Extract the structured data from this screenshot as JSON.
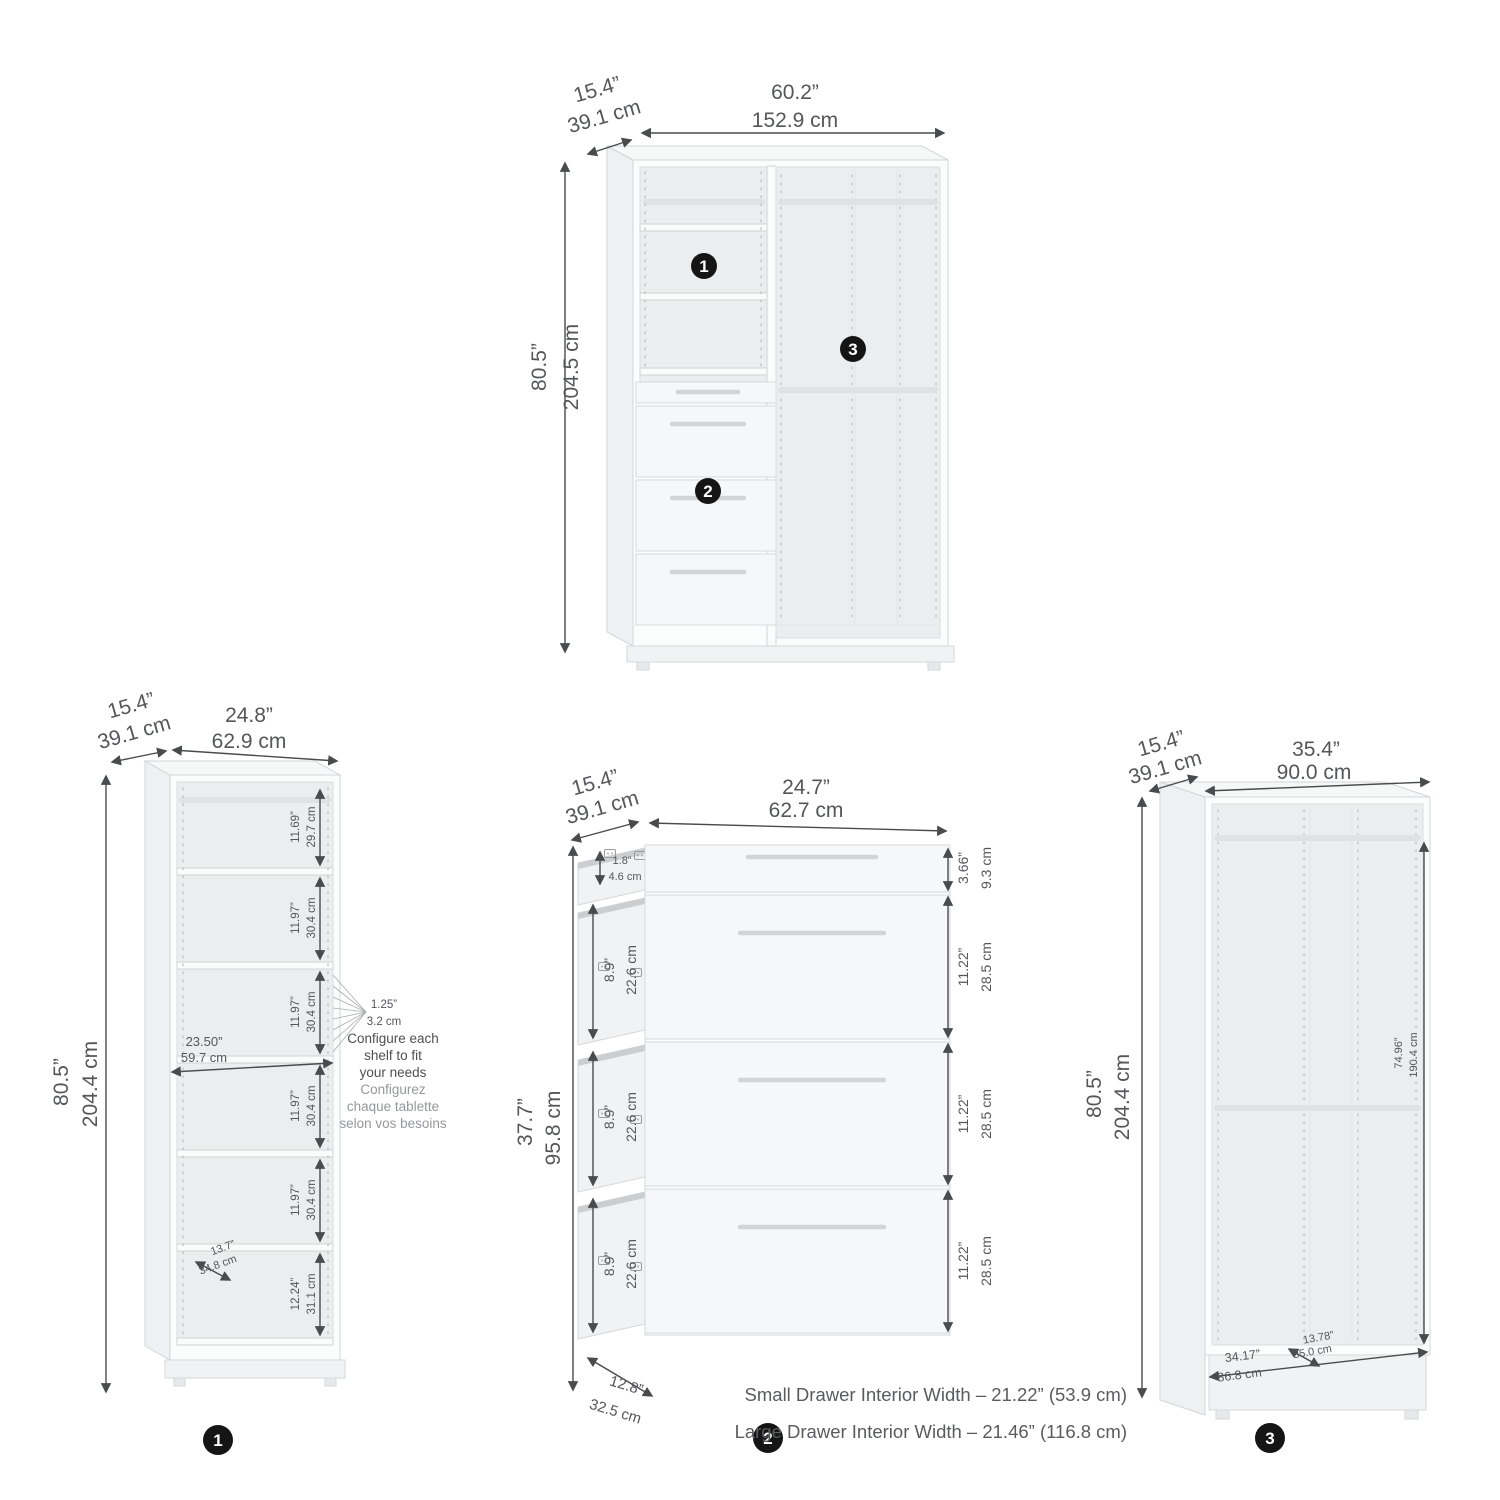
{
  "callouts": {
    "c1": "1",
    "c2": "2",
    "c3": "3"
  },
  "top_unit": {
    "depth_in": "15.4”",
    "depth_cm": "39.1 cm",
    "width_in": "60.2”",
    "width_cm": "152.9 cm",
    "height_in": "80.5”",
    "height_cm": "204.5 cm"
  },
  "shelf_unit": {
    "depth_in": "15.4”",
    "depth_cm": "39.1 cm",
    "width_in": "24.8”",
    "width_cm": "62.9 cm",
    "height_in": "80.5”",
    "height_cm": "204.4 cm",
    "sections": [
      {
        "in": "11.69”",
        "cm": "29.7 cm"
      },
      {
        "in": "11.97”",
        "cm": "30.4 cm"
      },
      {
        "in": "11.97”",
        "cm": "30.4 cm"
      },
      {
        "in": "11.97”",
        "cm": "30.4 cm"
      },
      {
        "in": "11.97”",
        "cm": "30.4 cm"
      },
      {
        "in": "12.24”",
        "cm": "31.1 cm"
      }
    ],
    "interior_width_in": "23.50”",
    "interior_width_cm": "59.7 cm",
    "shelf_depth_in": "13.7”",
    "shelf_depth_cm": "34.8 cm",
    "pin_in": "1.25”",
    "pin_cm": "3.2 cm",
    "note_en": [
      "Configure each",
      "shelf to fit",
      "your needs"
    ],
    "note_fr": [
      "Configurez",
      "chaque tablette",
      "selon vos besoins"
    ]
  },
  "drawer_unit": {
    "depth_in": "15.4”",
    "depth_cm": "39.1 cm",
    "width_in": "24.7”",
    "width_cm": "62.7 cm",
    "height_in": "37.7”",
    "height_cm": "95.8 cm",
    "small_int_in": "1.8”",
    "small_int_cm": "4.6 cm",
    "large_int_in": "8.9”",
    "large_int_cm": "22.6 cm",
    "front_small_in": "3.66”",
    "front_small_cm": "9.3 cm",
    "front_large_in": "11.22”",
    "front_large_cm": "28.5 cm",
    "bottom_in": "12.8”",
    "bottom_cm": "32.5 cm"
  },
  "wardrobe_unit": {
    "depth_in": "15.4”",
    "depth_cm": "39.1 cm",
    "width_in": "35.4”",
    "width_cm": "90.0 cm",
    "height_in": "80.5”",
    "height_cm": "204.4 cm",
    "int_h_in": "74.96”",
    "int_h_cm": "190.4 cm",
    "int_w_in": "34.17”",
    "int_w_cm": "86.8 cm",
    "int_d_in": "13.78”",
    "int_d_cm": "35.0 cm"
  },
  "footnotes": {
    "small": "Small Drawer Interior Width – 21.22” (53.9 cm)",
    "large": "Large Drawer Interior Width – 21.46” (116.8 cm)"
  }
}
